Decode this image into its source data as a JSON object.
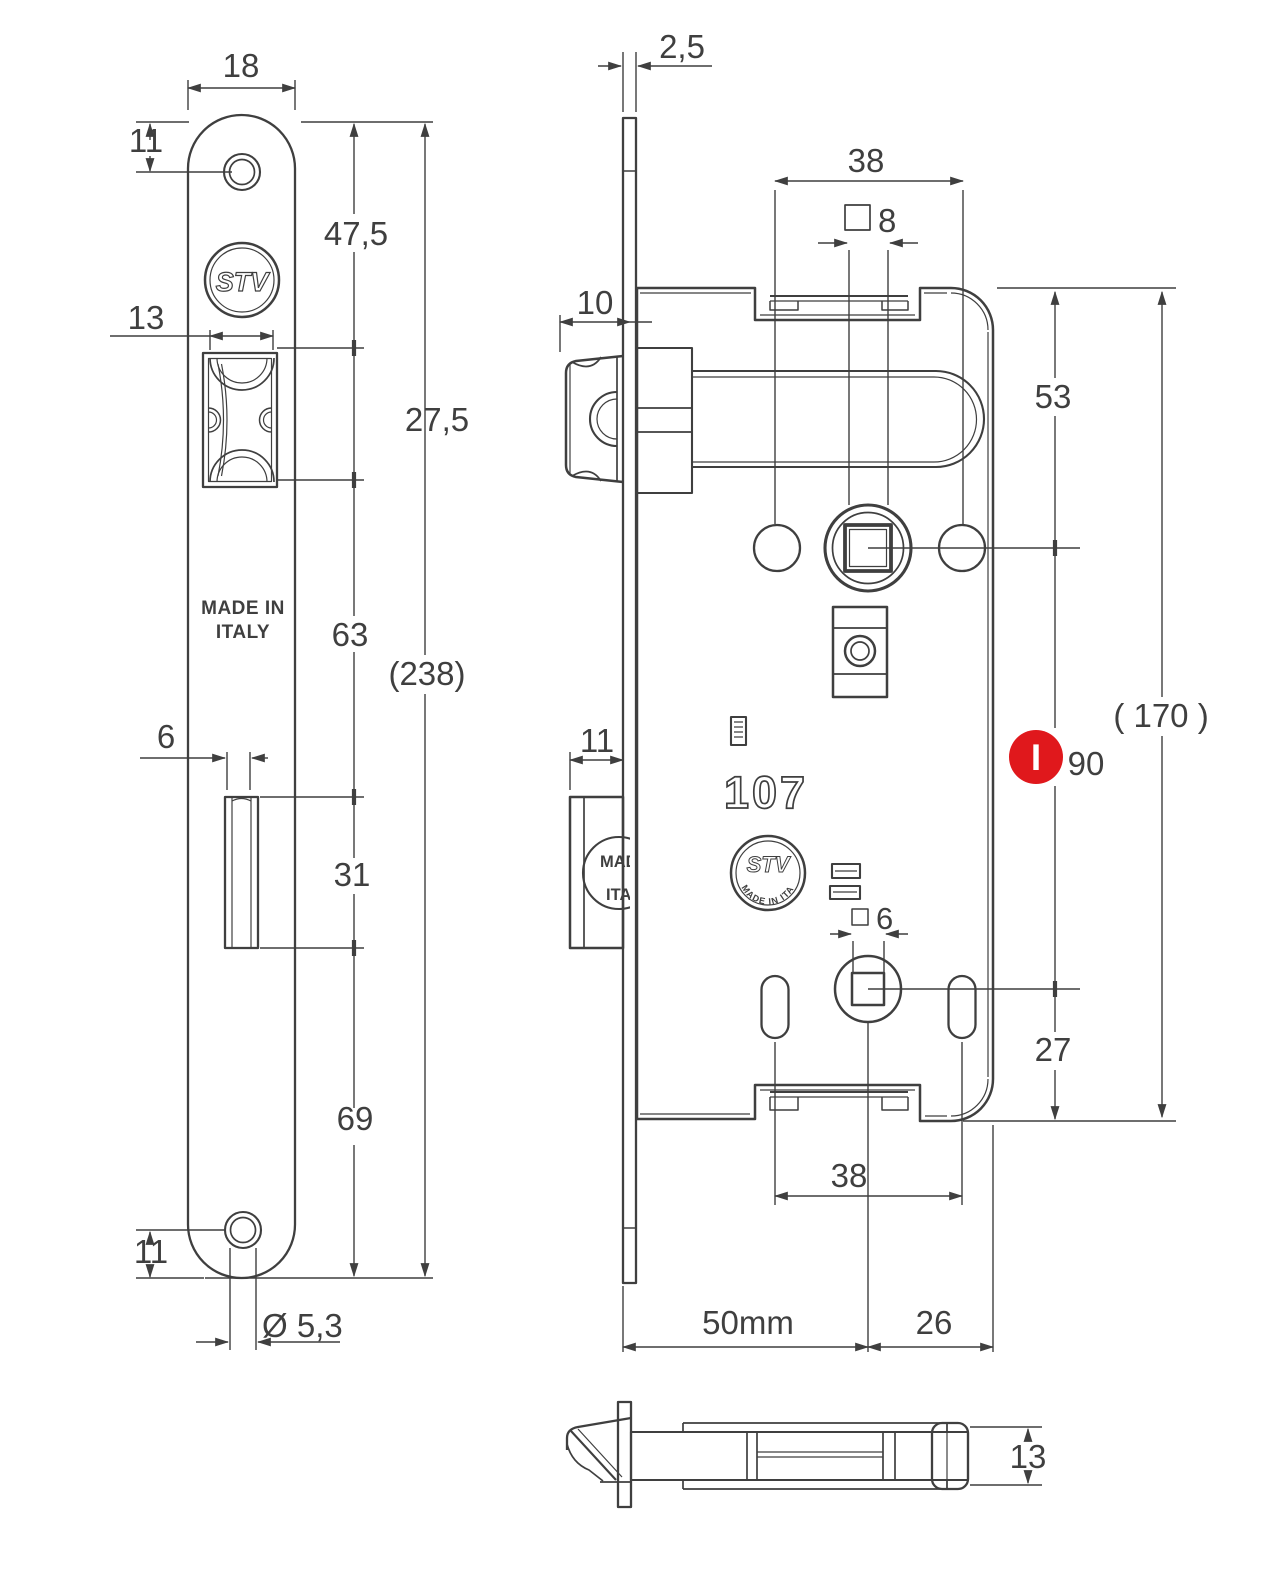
{
  "title": "STV 107 mortise lock technical drawing",
  "colors": {
    "line": "#3f3f3f",
    "red": "#e0181c",
    "background": "#ffffff"
  },
  "front_view": {
    "logo": "STV",
    "made_in_line1": "MADE IN",
    "made_in_line2": "ITALY",
    "dims": {
      "width": "18",
      "top_screw_offset": "11",
      "top_to_latch": "47,5",
      "latch_width": "13",
      "latch_height": "27,5",
      "latch_to_bolt": "63",
      "overall_height": "(238)",
      "bolt_width": "6",
      "bolt_height": "31",
      "bolt_to_bottom": "69",
      "bottom_screw_offset": "11",
      "screw_hole_dia": "Ø 5,3"
    }
  },
  "side_view": {
    "model_number": "107",
    "logo": "STV",
    "logo_ring": "MADE IN ITALY",
    "bolt_stamp_line1": "MADE IN",
    "bolt_stamp_line2": "ITALY",
    "marker_label": "I",
    "dims": {
      "faceplate_thickness": "2,5",
      "screw_spacing_top": "38",
      "handle_square": "8",
      "latch_protrusion": "10",
      "top_to_handle": "53",
      "bolt_thickness": "11",
      "wc_square": "6",
      "overall_height": "( 170 )",
      "handle_to_wc": "90",
      "wc_to_bottom": "27",
      "screw_spacing_bottom": "38",
      "backset": "50mm",
      "handle_to_back": "26"
    }
  },
  "bottom_view": {
    "dims": {
      "case_thickness": "13"
    }
  }
}
